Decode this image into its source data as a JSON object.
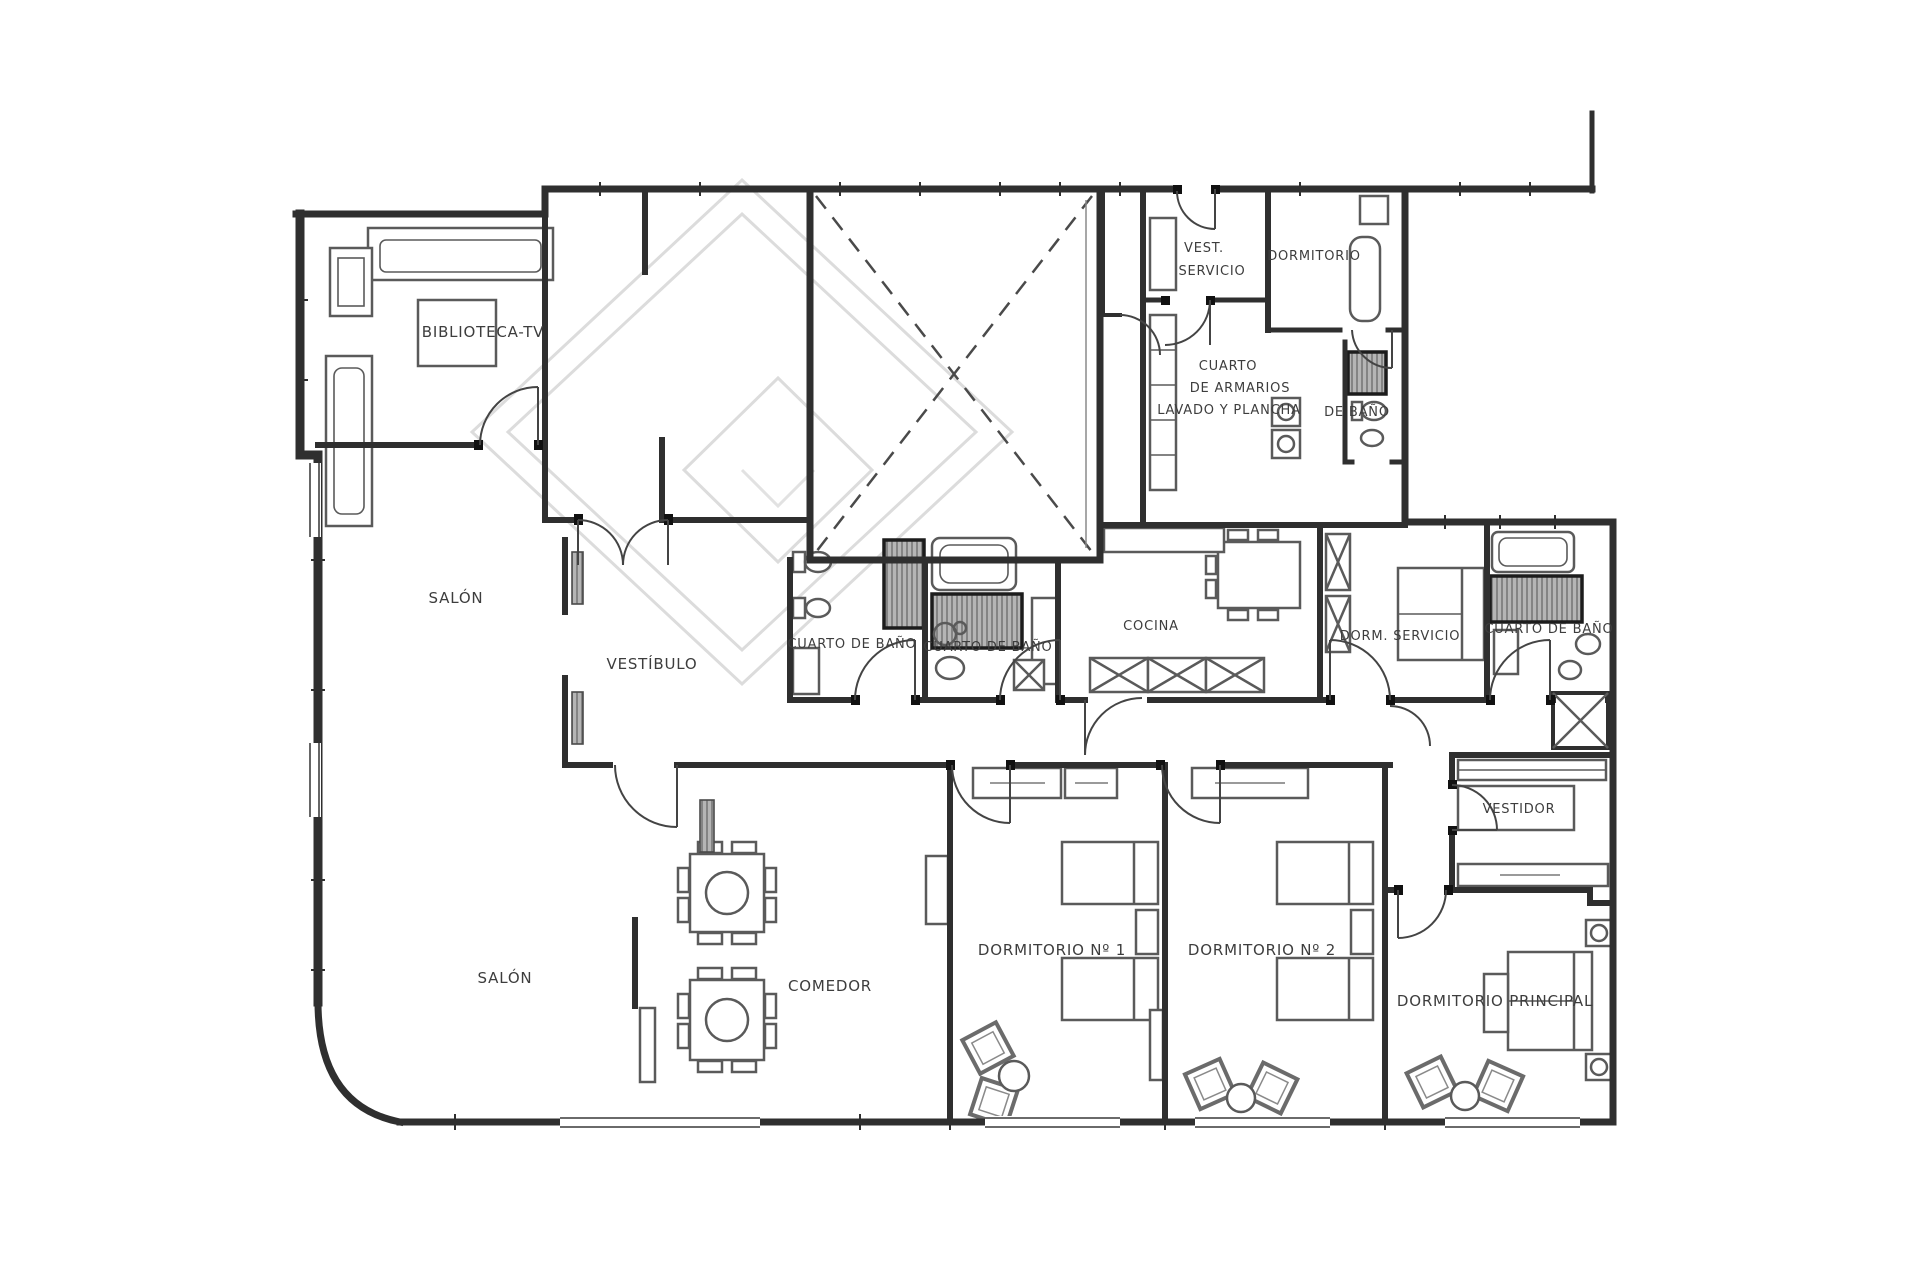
{
  "plan": {
    "type": "apartment-floor-plan",
    "language": "es",
    "colors": {
      "background": "#ffffff",
      "wall": "#2f2f2f",
      "furniture": "#5a5a5a",
      "hatch_fill": "#b5b5b5",
      "hatch_line": "#6e6e6e",
      "watermark": "#dcdcdc",
      "label": "#3d3d3d"
    },
    "rooms": [
      {
        "id": "biblioteca",
        "label": "BIBLIOTECA-TV"
      },
      {
        "id": "salon-superior",
        "label": "SALÓN"
      },
      {
        "id": "vestibulo",
        "label": "VESTÍBULO"
      },
      {
        "id": "salon-inferior",
        "label": "SALÓN"
      },
      {
        "id": "comedor",
        "label": "COMEDOR"
      },
      {
        "id": "cuarto-bano-1",
        "label": "CUARTO DE BAÑO"
      },
      {
        "id": "cuarto-bano-2",
        "label": "CUARTO DE BAÑO"
      },
      {
        "id": "cocina",
        "label": "COCINA"
      },
      {
        "id": "vest-servicio-1",
        "label": "VEST."
      },
      {
        "id": "vest-servicio-2",
        "label": "SERVICIO"
      },
      {
        "id": "dormitorio-serv",
        "label": "DORMITORIO"
      },
      {
        "id": "armarios-1",
        "label": "CUARTO"
      },
      {
        "id": "armarios-2",
        "label": "DE ARMARIOS"
      },
      {
        "id": "lavado",
        "label": "LAVADO Y PLANCHA"
      },
      {
        "id": "de-bano",
        "label": "DE BAÑO"
      },
      {
        "id": "dorm-servicio",
        "label": "DORM. SERVICIO"
      },
      {
        "id": "cuarto-bano-3",
        "label": "CUARTO DE BAÑO"
      },
      {
        "id": "vestidor",
        "label": "VESTIDOR"
      },
      {
        "id": "dormitorio-1",
        "label": "DORMITORIO Nº 1"
      },
      {
        "id": "dormitorio-2",
        "label": "DORMITORIO Nº 2"
      },
      {
        "id": "dormitorio-ppal",
        "label": "DORMITORIO PRINCIPAL"
      }
    ]
  }
}
